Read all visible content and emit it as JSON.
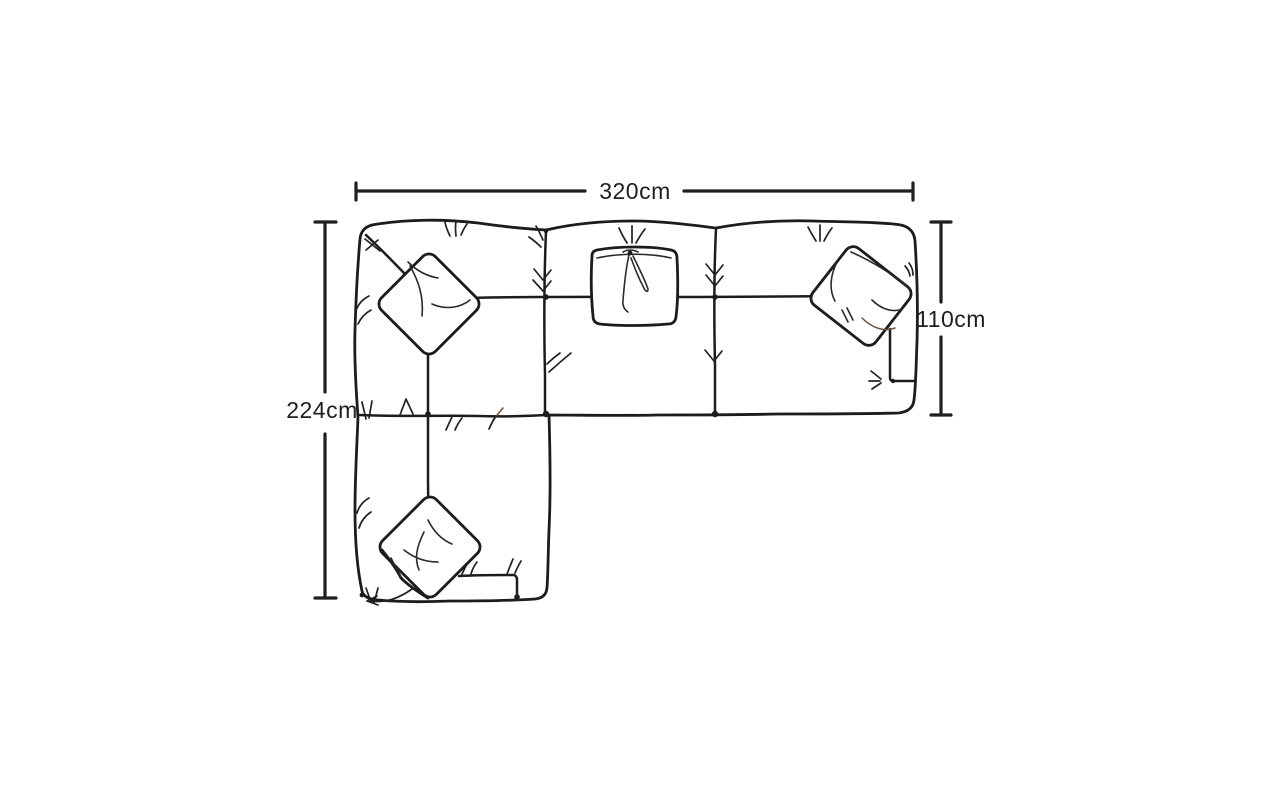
{
  "page": {
    "background_color": "#ffffff"
  },
  "diagram": {
    "stroke_color": "#1c1c1c",
    "sofa": {
      "view": "top-view corner sofa sketch",
      "seat_sections": 3,
      "chaise_position": "bottom-left",
      "scatter_cushions": 4
    },
    "dimensions": {
      "width_top": {
        "label": "320cm",
        "value": 320,
        "unit": "cm",
        "side": "top"
      },
      "depth_right": {
        "label": "110cm",
        "value": 110,
        "unit": "cm",
        "side": "right"
      },
      "length_left": {
        "label": "224cm",
        "value": 224,
        "unit": "cm",
        "side": "left"
      }
    }
  }
}
